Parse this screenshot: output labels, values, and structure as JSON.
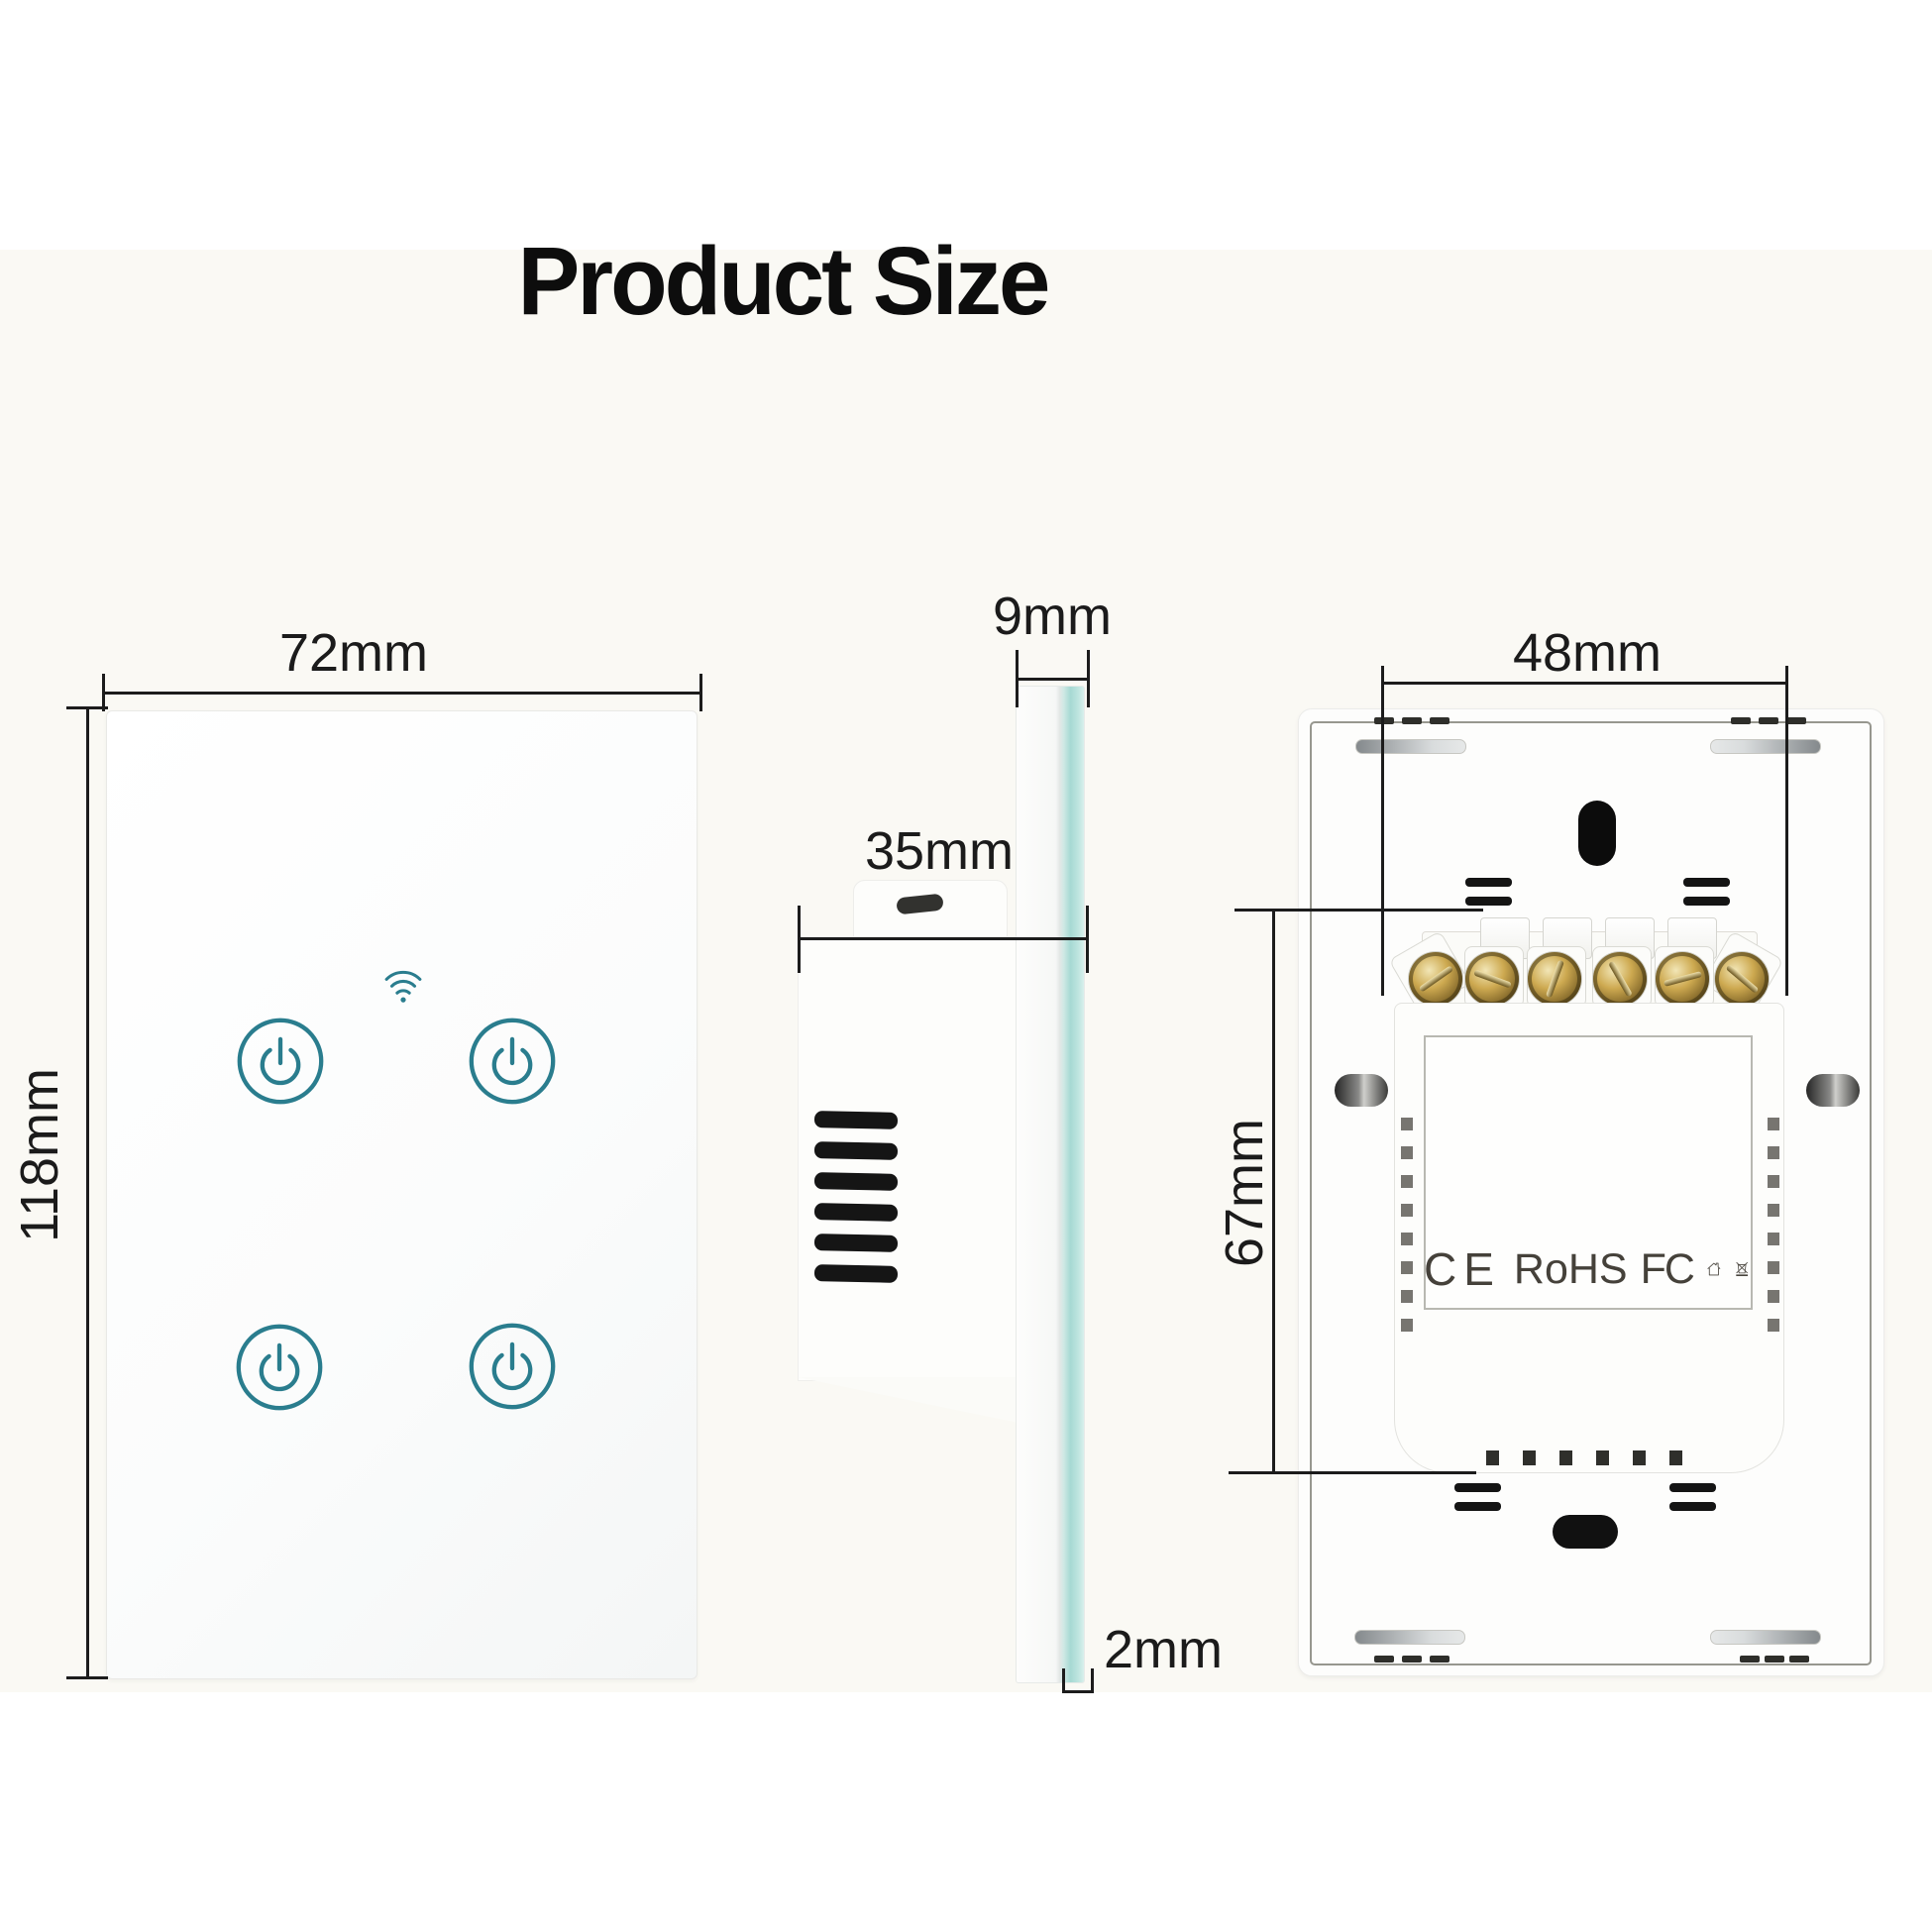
{
  "title": "Product Size",
  "dimensions": {
    "front_width": "72mm",
    "front_height": "118mm",
    "side_glass": "9mm",
    "side_depth": "35mm",
    "side_thickness": "2mm",
    "back_width": "48mm",
    "back_height": "67mm"
  },
  "certifications": {
    "ce": "CE",
    "rohs": "RoHS",
    "fcc": "FC"
  },
  "icons": [
    "wifi-icon",
    "power-button-icon",
    "house-icon",
    "waste-bin-icon",
    "screw-icon",
    "keyhole-icon"
  ],
  "colors": {
    "accent_teal": "#2a7d8e",
    "glass_edge_teal": "#a6d9d3",
    "ink": "#1b1b1b",
    "background": "#faf9f4"
  }
}
